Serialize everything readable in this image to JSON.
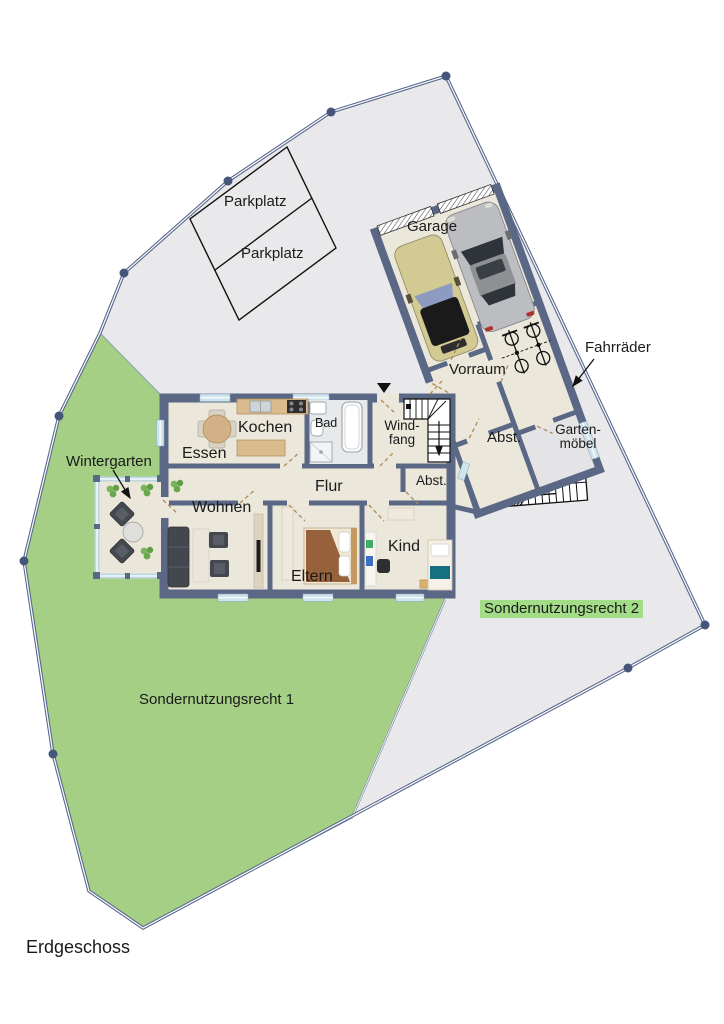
{
  "floor_title": "Erdgeschoss",
  "labels": {
    "wintergarten": "Wintergarten",
    "essen": "Essen",
    "kochen": "Kochen",
    "bad": "Bad",
    "windfang_line1": "Wind-",
    "windfang_line2": "fang",
    "flur": "Flur",
    "abstellraum_haus": "Abst.",
    "wohnen": "Wohnen",
    "eltern": "Eltern",
    "kind": "Kind",
    "garage": "Garage",
    "vorraum": "Vorraum",
    "abstellraum_anbau": "Abst.",
    "gartenmoebel_line1": "Garten-",
    "gartenmoebel_line2": "möbel",
    "fahrraeder": "Fahrräder",
    "parkplatz_1": "Parkplatz",
    "parkplatz_2": "Parkplatz",
    "sondernutzungsrecht_1": "Sondernutzungsrecht 1",
    "sondernutzungsrecht_2": "Sondernutzungsrecht 2"
  },
  "theme": {
    "wall": "#5a6886",
    "floor": "#ece7db",
    "lawn": "#a5cf85",
    "paving": "#e9e9eb",
    "boundary": "#54648a",
    "glass": "#cfe4ee",
    "wood": "#d9bb8d",
    "highlight": "#a3dc87",
    "text": "#1a1a1a"
  }
}
